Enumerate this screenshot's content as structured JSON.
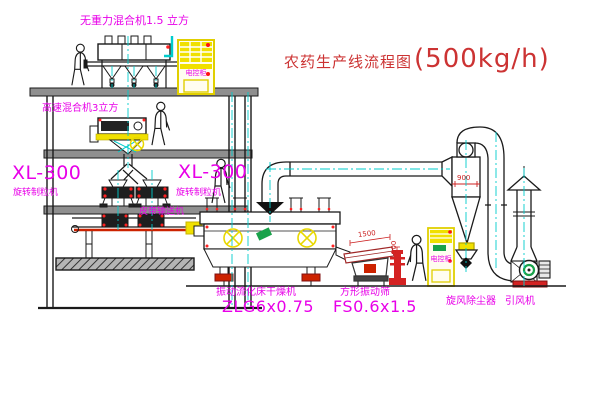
{
  "title": {
    "name": "农药生产线流程图",
    "capacity": "(500kg/h)"
  },
  "equipment_labels": {
    "gravity_mixer": "无重力混合机1.5 立方",
    "high_speed_mixer": "高速混合机3立方",
    "granulator_left_model": "XL-300",
    "granulator_left_name": "旋转制粒机",
    "granulator_right_model": "XL-300",
    "granulator_right_name": "旋转制粒机",
    "belt_conveyor": "皮带输送机",
    "dryer_name": "振动流化床干燥机",
    "dryer_model": "ZLG6x0.75",
    "screen_name": "方形振动筛",
    "screen_model": "FS0.6x1.5",
    "cyclone_name": "旋风除尘器",
    "fan_name": "引风机",
    "cabinet_top": "电控柜",
    "cabinet_ground": "电控柜"
  },
  "dimensions": {
    "screen_length": "1500",
    "screen_height": "500",
    "cyclone_inlet": "900"
  },
  "colors": {
    "label_magenta": "#e800e8",
    "title_red": "#cc3333",
    "dimension_red": "#cc2222",
    "centerline_cyan": "#00cccc",
    "cabinet_yellow": "#f0e000",
    "machine_green": "#19a24a",
    "belt_red": "#cc2200",
    "line_black": "#1a1a1a",
    "background": "#ffffff"
  }
}
